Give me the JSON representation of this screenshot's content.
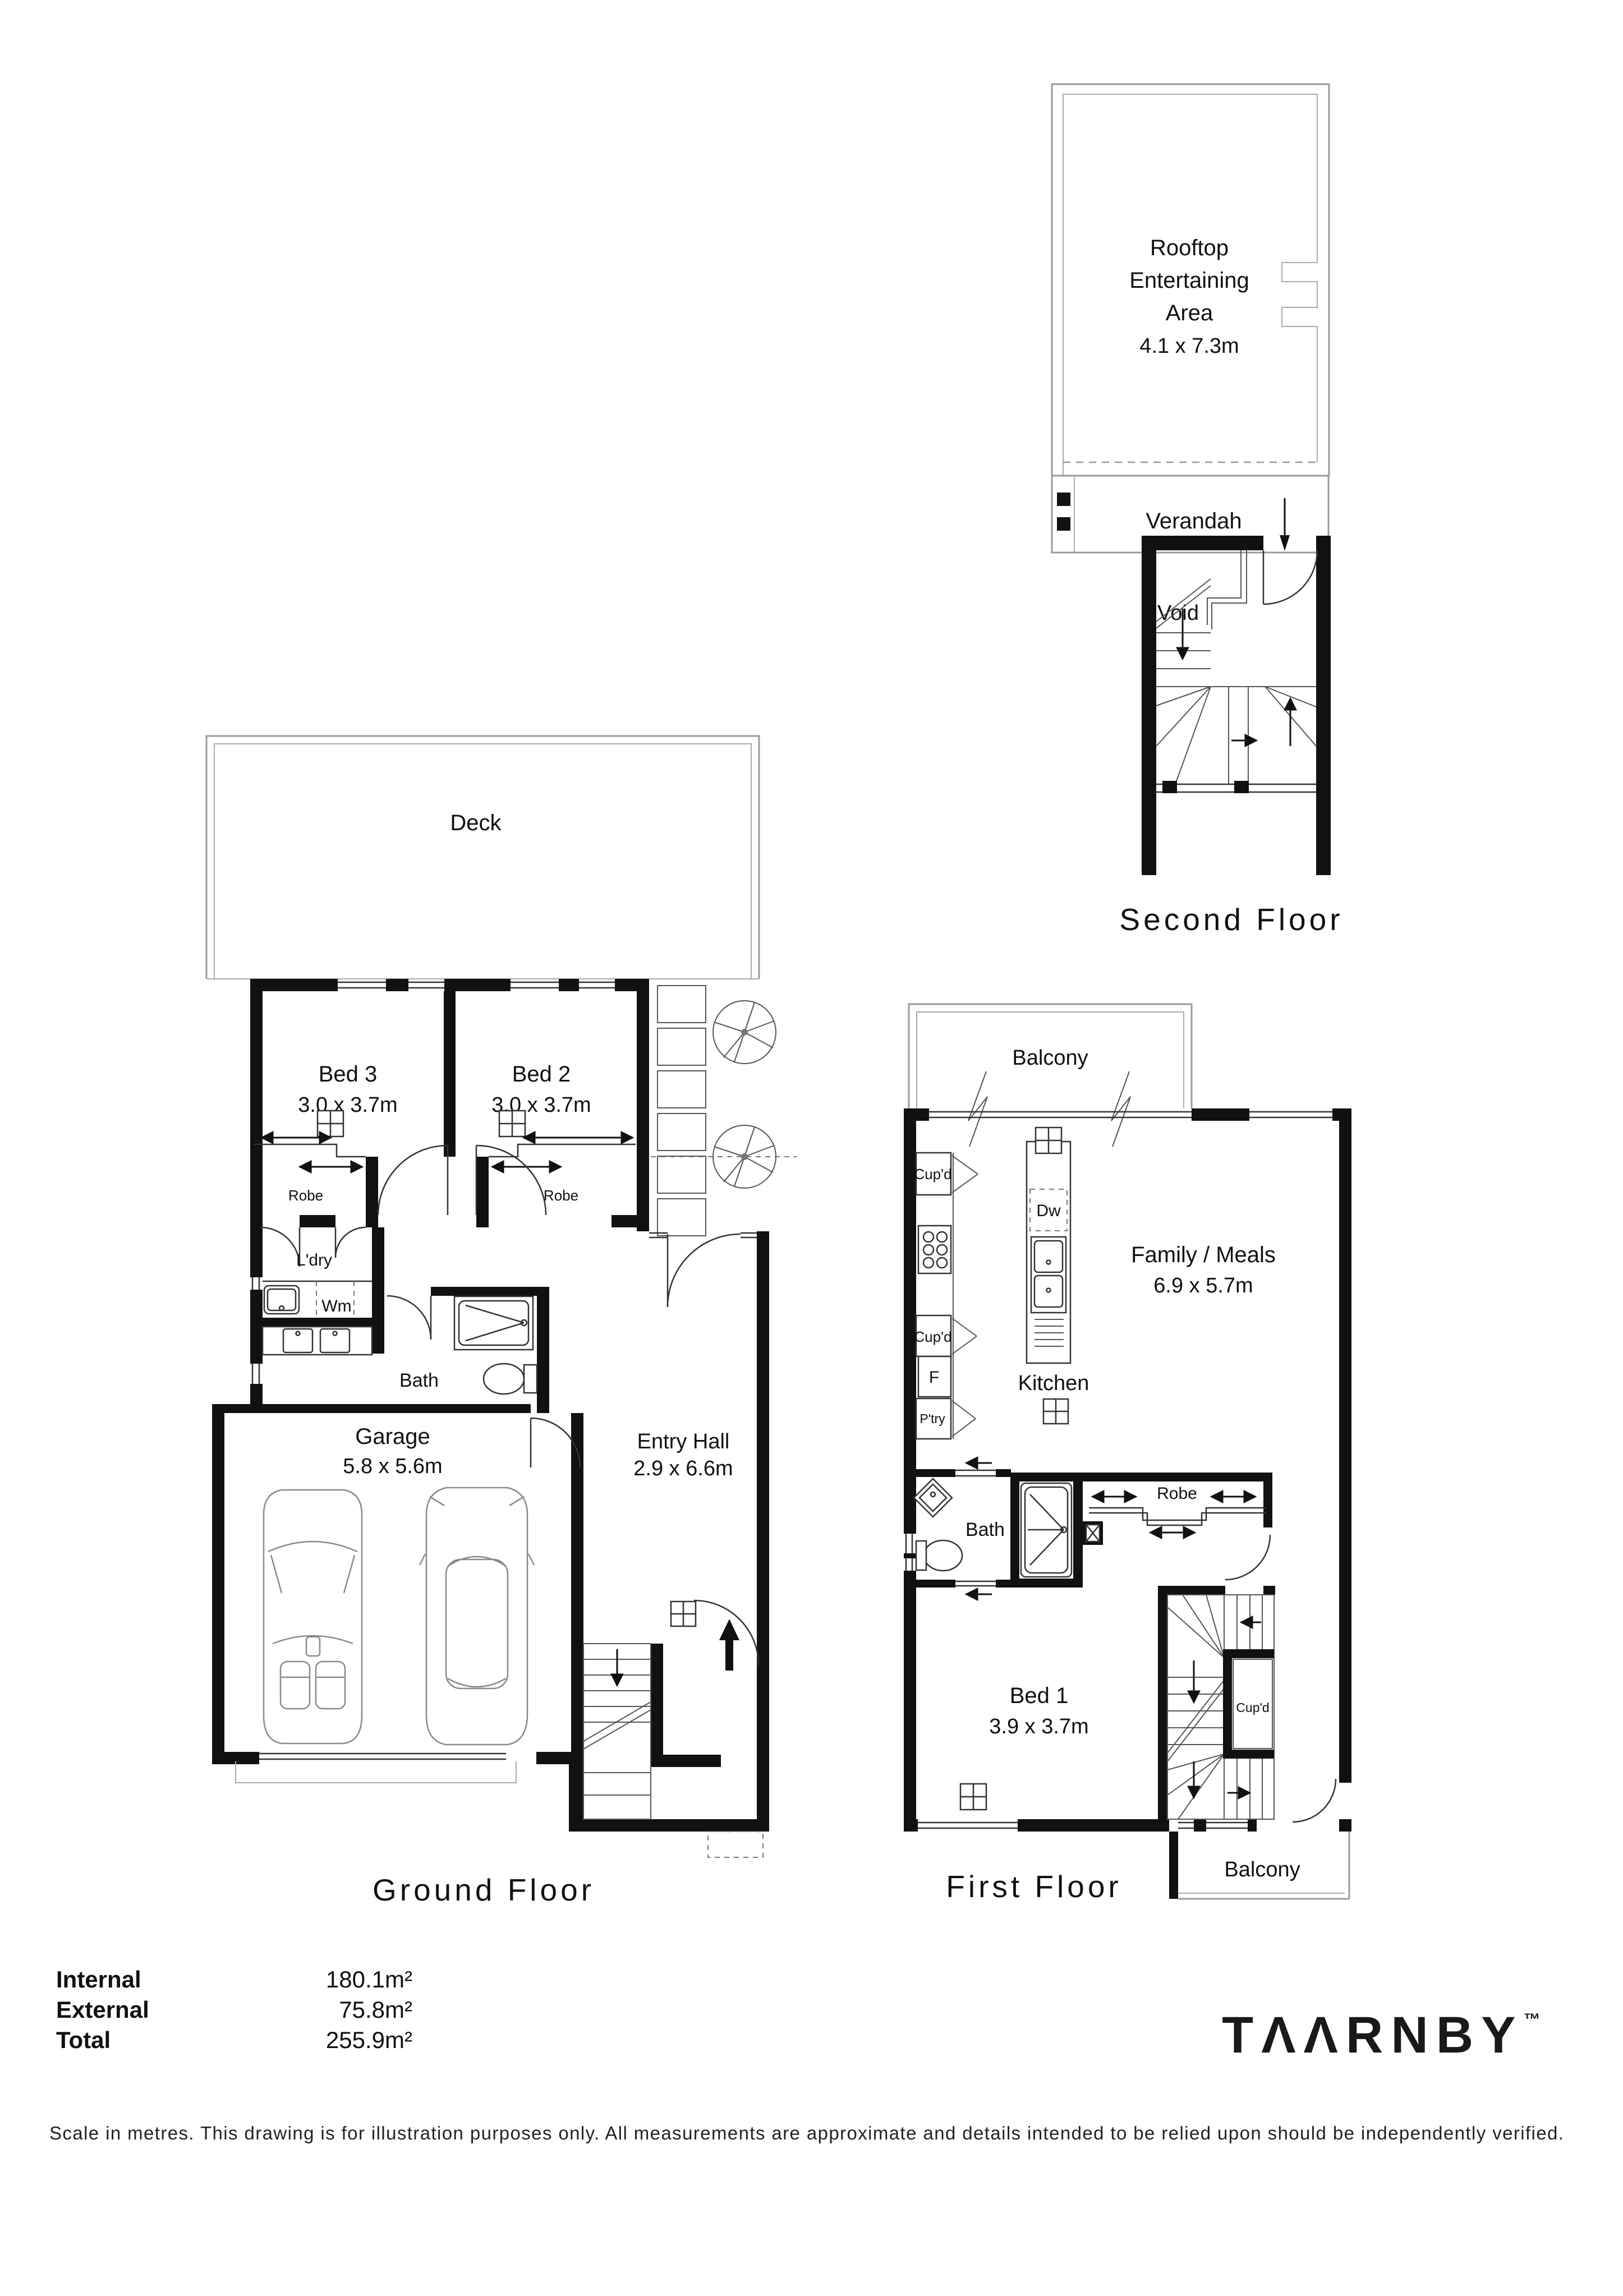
{
  "document": {
    "type": "floor-plan",
    "background": "#ffffff",
    "ink": "#111111"
  },
  "floors": {
    "second": {
      "title": "Second Floor",
      "rooms": {
        "rooftop": {
          "name_lines": [
            "Rooftop",
            "Entertaining",
            "Area"
          ],
          "dims": "4.1 x 7.3m"
        },
        "verandah": {
          "name": "Verandah"
        },
        "void": {
          "name": "Void"
        }
      }
    },
    "ground": {
      "title": "Ground Floor",
      "rooms": {
        "deck": {
          "name": "Deck"
        },
        "bed3": {
          "name": "Bed 3",
          "dims": "3.0 x 3.7m"
        },
        "bed2": {
          "name": "Bed 2",
          "dims": "3.0 x 3.7m"
        },
        "robe_bed3": {
          "name": "Robe"
        },
        "robe_bed2": {
          "name": "Robe"
        },
        "laundry": {
          "name": "L'dry"
        },
        "wm": {
          "name": "Wm"
        },
        "bath": {
          "name": "Bath"
        },
        "garage": {
          "name": "Garage",
          "dims": "5.8 x 5.6m"
        },
        "entry_hall": {
          "name": "Entry Hall",
          "dims": "2.9 x 6.6m"
        }
      }
    },
    "first": {
      "title": "First Floor",
      "rooms": {
        "balcony_top": {
          "name": "Balcony"
        },
        "kitchen": {
          "name": "Kitchen"
        },
        "cupd_upper": {
          "name": "Cup'd"
        },
        "cupd_lower": {
          "name": "Cup'd"
        },
        "fridge": {
          "name": "F"
        },
        "pantry": {
          "name": "P'try"
        },
        "dishwasher": {
          "name": "Dw"
        },
        "family_meals": {
          "name": "Family / Meals",
          "dims": "6.9 x 5.7m"
        },
        "bath": {
          "name": "Bath"
        },
        "robe": {
          "name": "Robe"
        },
        "bed1": {
          "name": "Bed 1",
          "dims": "3.9 x 3.7m"
        },
        "cupd_stairs": {
          "name": "Cup'd"
        },
        "balcony_bottom": {
          "name": "Balcony"
        }
      }
    }
  },
  "areas": {
    "rows": [
      {
        "label": "Internal",
        "value": "180.1m²"
      },
      {
        "label": "External",
        "value": "75.8m²"
      },
      {
        "label": "Total",
        "value": "255.9m²"
      }
    ]
  },
  "brand": {
    "name": "TΛΛRNBY",
    "trademark": "™"
  },
  "footer": {
    "disclaimer": "Scale in metres. This drawing is for illustration purposes only. All measurements are approximate and details intended to be relied upon should be independently verified."
  }
}
